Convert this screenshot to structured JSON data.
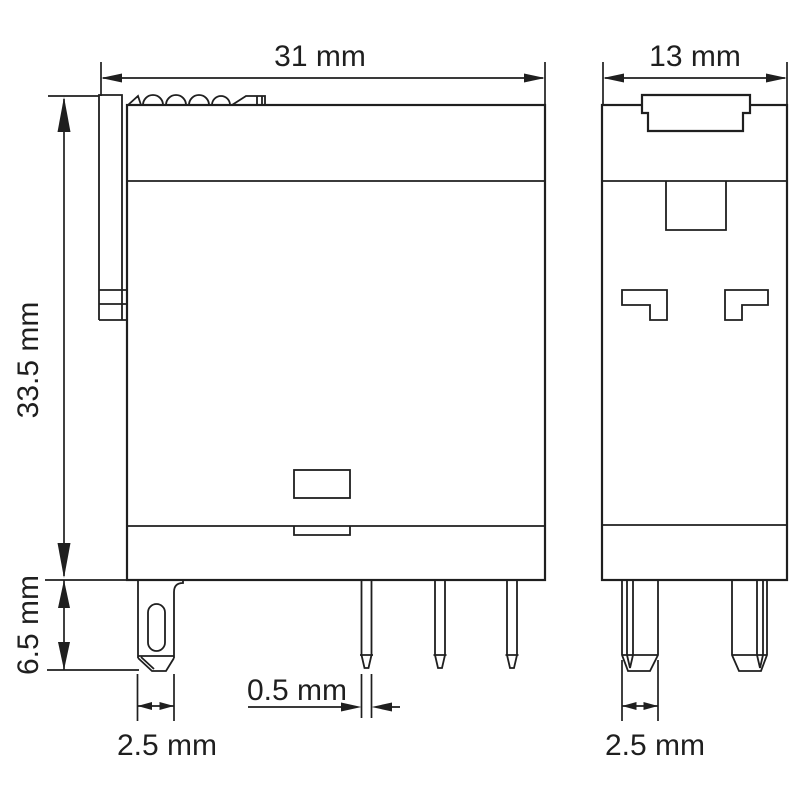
{
  "drawing": {
    "type": "technical-dimension-drawing",
    "component": "relay-module-two-views",
    "background_color": "#ffffff",
    "line_color": "#1f1f1f",
    "dims": {
      "front_width": "31 mm",
      "side_depth": "13 mm",
      "body_height": "33.5 mm",
      "pin_length": "6.5 mm",
      "front_pin_width": "2.5 mm",
      "pin_thickness": "0.5 mm",
      "side_pin_width": "2.5 mm"
    }
  }
}
